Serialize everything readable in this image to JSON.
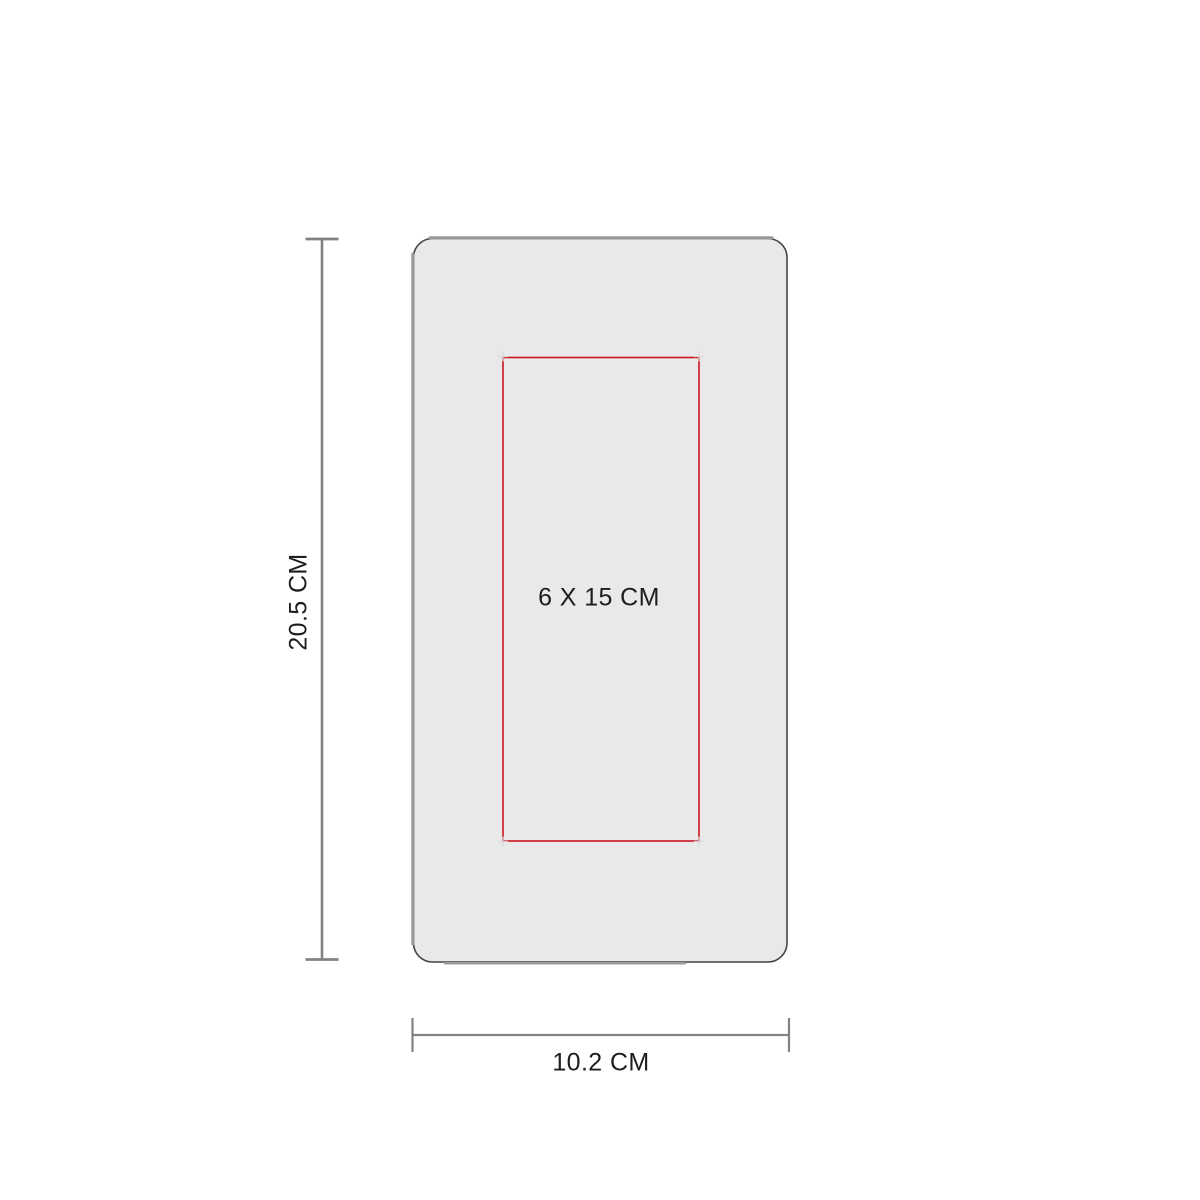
{
  "diagram": {
    "height_dimension": {
      "label": "20.5 CM"
    },
    "width_dimension": {
      "label": "10.2 CM"
    },
    "imprint_area": {
      "label": "6 X 15 CM"
    },
    "colors": {
      "background": "#ffffff",
      "product_fill": "#e9e9e9",
      "product_outline": "#454545",
      "product_accent": "#9a9a9a",
      "imprint_stroke": "#cd1420",
      "dimension_line": "#828282",
      "corner_mark": "#d8dadb",
      "text": "#1d1d1b"
    }
  }
}
